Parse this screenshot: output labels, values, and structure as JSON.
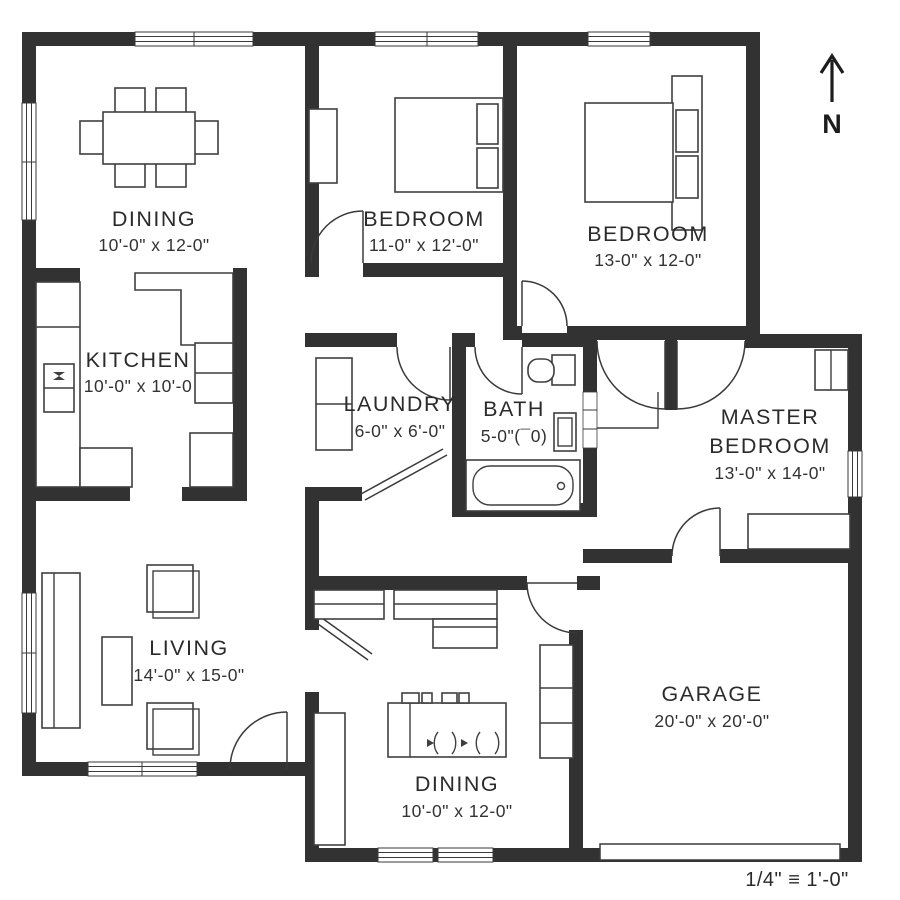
{
  "plan": {
    "north_label": "N",
    "scale_label": "1/4\" ≡ 1'-0\"",
    "colors": {
      "wall": "#323232",
      "text": "#2b2b2b",
      "line": "#3f3f3f",
      "background": "#ffffff"
    },
    "rooms": {
      "dining_top": {
        "name": "DINING",
        "dims": "10'-0\" x 12-0\""
      },
      "bedroom_middle": {
        "name": "BEDROOM",
        "dims": "11-0\" x 12'-0\""
      },
      "bedroom_right": {
        "name": "BEDROOM",
        "dims": "13-0\" x 12-0\""
      },
      "kitchen": {
        "name": "KITCHEN",
        "dims": "10'-0\" x 10'-0"
      },
      "laundry": {
        "name": "LAUNDRY",
        "dims": "6-0\" x 6'-0\""
      },
      "bath": {
        "name": "BATH",
        "dims": "5-0\"(¯0)"
      },
      "master_bedroom": {
        "name": "MASTER",
        "name_line2": "BEDROOM",
        "dims": "13'-0\" x 14-0\""
      },
      "living": {
        "name": "LIVING",
        "dims": "14'-0\" x 15-0\""
      },
      "garage": {
        "name": "GARAGE",
        "dims": "20'-0\" x 20'-0\""
      },
      "dining_bottom": {
        "name": "DINING",
        "dims": "10'-0\" x 12-0\""
      }
    }
  }
}
